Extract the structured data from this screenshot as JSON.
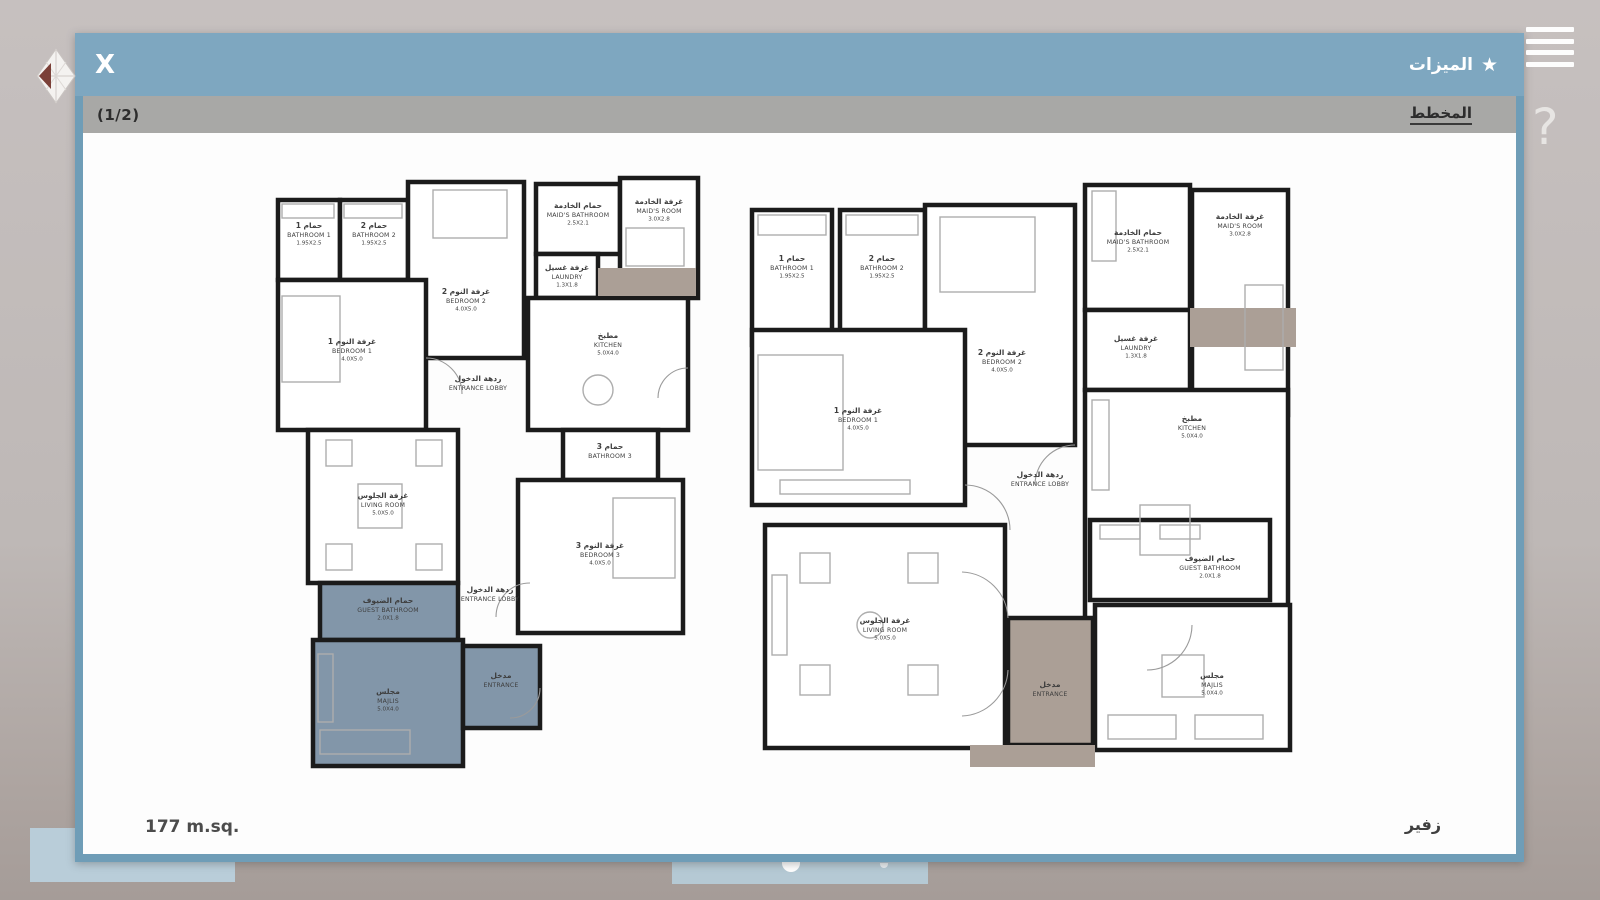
{
  "chrome": {
    "menu_icon": "hamburger-icon",
    "help_label": "?",
    "logo": "diamond-logo"
  },
  "dialog": {
    "close_label": "X",
    "features_label": "الميزات",
    "star_icon": "★",
    "pagination": "(1/2)",
    "plan_tab": "المخطط",
    "area_label": "177 m.sq.",
    "model_name": "زفير"
  },
  "colors": {
    "header_blue": "#7ea7c0",
    "dialog_border": "#6f9db7",
    "subheader_gray": "#a8a8a6",
    "wall": "#1b1b1b",
    "furniture": "#adadad",
    "porch": "#ab9f96",
    "blue_room": "#8296a9",
    "room_fill": "#ffffff",
    "label": "#3e3e3e"
  },
  "plans": [
    {
      "id": "left-floor-plan",
      "x": 185,
      "y": 35,
      "w": 436,
      "h": 604,
      "porches": [
        [
          330,
          100,
          98,
          28
        ]
      ],
      "rooms": [
        {
          "id": "bathroom-1",
          "r": [
            10,
            32,
            62,
            80
          ],
          "label": {
            "x": 41,
            "y": 60,
            "ar": "حمام 1",
            "en": "BATHROOM 1",
            "dim": "1.95X2.5"
          }
        },
        {
          "id": "bathroom-2",
          "r": [
            72,
            32,
            68,
            80
          ],
          "label": {
            "x": 106,
            "y": 60,
            "ar": "حمام 2",
            "en": "BATHROOM 2",
            "dim": "1.95X2.5"
          }
        },
        {
          "id": "bedroom-2",
          "r": [
            140,
            14,
            116,
            176
          ],
          "label": {
            "x": 198,
            "y": 126,
            "ar": "غرفة النوم 2",
            "en": "BEDROOM 2",
            "dim": "4.0X5.0"
          }
        },
        {
          "id": "maids-bathroom",
          "r": [
            268,
            16,
            84,
            70
          ],
          "label": {
            "x": 310,
            "y": 40,
            "ar": "حمام الخادمة",
            "en": "MAID'S BATHROOM",
            "dim": "2.5X2.1"
          }
        },
        {
          "id": "maids-room",
          "r": [
            352,
            10,
            78,
            120
          ],
          "label": {
            "x": 391,
            "y": 36,
            "ar": "غرفة الخادمة",
            "en": "MAID'S ROOM",
            "dim": "3.0X2.8"
          }
        },
        {
          "id": "laundry",
          "r": [
            268,
            86,
            62,
            44
          ],
          "label": {
            "x": 299,
            "y": 102,
            "ar": "غرفة غسيل",
            "en": "LAUNDRY",
            "dim": "1.3X1.8"
          }
        },
        {
          "id": "kitchen",
          "r": [
            260,
            130,
            160,
            132
          ],
          "label": {
            "x": 340,
            "y": 170,
            "ar": "مطبخ",
            "en": "KITCHEN",
            "dim": "5.0X4.0"
          }
        },
        {
          "id": "bedroom-1",
          "r": [
            10,
            112,
            148,
            150
          ],
          "label": {
            "x": 84,
            "y": 176,
            "ar": "غرفة النوم 1",
            "en": "BEDROOM 1",
            "dim": "4.0X5.0"
          }
        },
        {
          "id": "bathroom-3",
          "r": [
            295,
            262,
            95,
            50
          ],
          "label": {
            "x": 342,
            "y": 281,
            "ar": "حمام 3",
            "en": "BATHROOM 3",
            "dim": ""
          }
        },
        {
          "id": "living-room",
          "r": [
            40,
            262,
            150,
            153
          ],
          "label": {
            "x": 115,
            "y": 330,
            "ar": "غرفة الجلوس",
            "en": "LIVING ROOM",
            "dim": "5.0X5.0"
          }
        },
        {
          "id": "bedroom-3",
          "r": [
            250,
            312,
            165,
            153
          ],
          "label": {
            "x": 332,
            "y": 380,
            "ar": "غرفة النوم 3",
            "en": "BEDROOM 3",
            "dim": "4.0X5.0"
          }
        },
        {
          "id": "guest-bathroom",
          "r": [
            52,
            415,
            138,
            57
          ],
          "fill": "blue",
          "label": {
            "x": 120,
            "y": 435,
            "ar": "حمام الضيوف",
            "en": "GUEST BATHROOM",
            "dim": "2.0X1.8"
          }
        },
        {
          "id": "majlis",
          "r": [
            45,
            472,
            150,
            126
          ],
          "fill": "blue",
          "label": {
            "x": 120,
            "y": 526,
            "ar": "مجلس",
            "en": "MAJLIS",
            "dim": "5.0X4.0"
          }
        },
        {
          "id": "entrance",
          "r": [
            195,
            478,
            77,
            82
          ],
          "fill": "blue",
          "label": {
            "x": 233,
            "y": 510,
            "ar": "مدخل",
            "en": "ENTRANCE",
            "dim": ""
          }
        }
      ],
      "open_labels": [
        {
          "x": 210,
          "y": 213,
          "ar": "ردهة الدخول",
          "en": "ENTRANCE LOBBY"
        },
        {
          "x": 222,
          "y": 424,
          "ar": "ردهة الدخول",
          "en": "ENTRANCE LOBBY"
        }
      ],
      "furniture": [
        {
          "t": "r",
          "d": [
            14,
            36,
            52,
            14
          ]
        },
        {
          "t": "r",
          "d": [
            76,
            36,
            58,
            14
          ]
        },
        {
          "t": "r",
          "d": [
            165,
            22,
            74,
            48
          ]
        },
        {
          "t": "r",
          "d": [
            14,
            128,
            58,
            86
          ]
        },
        {
          "t": "r",
          "d": [
            358,
            60,
            58,
            38
          ]
        },
        {
          "t": "r",
          "d": [
            58,
            272,
            26,
            26
          ]
        },
        {
          "t": "r",
          "d": [
            148,
            272,
            26,
            26
          ]
        },
        {
          "t": "r",
          "d": [
            58,
            376,
            26,
            26
          ]
        },
        {
          "t": "r",
          "d": [
            148,
            376,
            26,
            26
          ]
        },
        {
          "t": "r",
          "d": [
            90,
            316,
            44,
            44
          ]
        },
        {
          "t": "r",
          "d": [
            345,
            330,
            62,
            80
          ]
        },
        {
          "t": "c",
          "d": [
            330,
            222,
            15
          ]
        },
        {
          "t": "r",
          "d": [
            52,
            562,
            90,
            24
          ]
        },
        {
          "t": "r",
          "d": [
            50,
            486,
            15,
            68
          ]
        }
      ],
      "arcs": [
        "M158,190 A36,36 0 0 1 194,226",
        "M262,415 A34,34 0 0 0 228,449",
        "M272,520 A30,30 0 0 1 242,550",
        "M420,200 A30,30 0 0 0 390,230"
      ]
    },
    {
      "id": "right-floor-plan",
      "x": 657,
      "y": 42,
      "w": 556,
      "h": 592,
      "porches": [
        [
          450,
          133,
          106,
          39
        ],
        [
          230,
          570,
          125,
          22
        ]
      ],
      "rooms": [
        {
          "id": "bathroom-1",
          "r": [
            12,
            35,
            80,
            135
          ],
          "label": {
            "x": 52,
            "y": 86,
            "ar": "حمام 1",
            "en": "BATHROOM 1",
            "dim": "1.95X2.5"
          }
        },
        {
          "id": "bathroom-2",
          "r": [
            100,
            35,
            85,
            135
          ],
          "label": {
            "x": 142,
            "y": 86,
            "ar": "حمام 2",
            "en": "BATHROOM 2",
            "dim": "1.95X2.5"
          }
        },
        {
          "id": "bedroom-2",
          "r": [
            185,
            30,
            150,
            240
          ],
          "label": {
            "x": 262,
            "y": 180,
            "ar": "غرفة النوم 2",
            "en": "BEDROOM 2",
            "dim": "4.0X5.0"
          }
        },
        {
          "id": "maids-bathroom",
          "r": [
            345,
            10,
            105,
            125
          ],
          "label": {
            "x": 398,
            "y": 60,
            "ar": "حمام الخادمة",
            "en": "MAID'S BATHROOM",
            "dim": "2.5X2.1"
          }
        },
        {
          "id": "maids-room",
          "r": [
            452,
            15,
            96,
            225
          ],
          "label": {
            "x": 500,
            "y": 44,
            "ar": "غرفة الخادمة",
            "en": "MAID'S ROOM",
            "dim": "3.0X2.8"
          }
        },
        {
          "id": "laundry",
          "r": [
            345,
            135,
            105,
            80
          ],
          "label": {
            "x": 396,
            "y": 166,
            "ar": "غرفة غسيل",
            "en": "LAUNDRY",
            "dim": "1.3X1.8"
          }
        },
        {
          "id": "kitchen",
          "r": [
            345,
            215,
            203,
            235
          ],
          "label": {
            "x": 452,
            "y": 246,
            "ar": "مطبخ",
            "en": "KITCHEN",
            "dim": "5.0X4.0"
          }
        },
        {
          "id": "bedroom-1",
          "r": [
            12,
            155,
            213,
            175
          ],
          "label": {
            "x": 118,
            "y": 238,
            "ar": "غرفة النوم 1",
            "en": "BEDROOM 1",
            "dim": "4.0X5.0"
          }
        },
        {
          "id": "living-room",
          "r": [
            25,
            350,
            240,
            223
          ],
          "label": {
            "x": 145,
            "y": 448,
            "ar": "غرفة الجلوس",
            "en": "LIVING ROOM",
            "dim": "5.0X5.0"
          }
        },
        {
          "id": "guest-bathroom",
          "r": [
            350,
            345,
            180,
            80
          ],
          "label": {
            "x": 470,
            "y": 386,
            "ar": "حمام الضيوف",
            "en": "GUEST BATHROOM",
            "dim": "2.0X1.8"
          }
        },
        {
          "id": "majlis",
          "r": [
            355,
            430,
            195,
            145
          ],
          "label": {
            "x": 472,
            "y": 503,
            "ar": "مجلس",
            "en": "MAJLIS",
            "dim": "5.0X4.0"
          }
        },
        {
          "id": "entrance",
          "r": [
            268,
            443,
            85,
            127
          ],
          "fill": "porch",
          "label": {
            "x": 310,
            "y": 512,
            "ar": "مدخل",
            "en": "ENTRANCE",
            "dim": ""
          }
        }
      ],
      "open_labels": [
        {
          "x": 300,
          "y": 302,
          "ar": "ردهة الدخول",
          "en": "ENTRANCE LOBBY"
        }
      ],
      "furniture": [
        {
          "t": "r",
          "d": [
            18,
            40,
            68,
            20
          ]
        },
        {
          "t": "r",
          "d": [
            106,
            40,
            72,
            20
          ]
        },
        {
          "t": "r",
          "d": [
            352,
            16,
            24,
            70
          ]
        },
        {
          "t": "r",
          "d": [
            200,
            42,
            95,
            75
          ]
        },
        {
          "t": "r",
          "d": [
            18,
            180,
            85,
            115
          ]
        },
        {
          "t": "r",
          "d": [
            505,
            110,
            38,
            85
          ]
        },
        {
          "t": "r",
          "d": [
            40,
            305,
            130,
            14
          ]
        },
        {
          "t": "r",
          "d": [
            60,
            378,
            30,
            30
          ]
        },
        {
          "t": "r",
          "d": [
            168,
            378,
            30,
            30
          ]
        },
        {
          "t": "r",
          "d": [
            60,
            490,
            30,
            30
          ]
        },
        {
          "t": "r",
          "d": [
            168,
            490,
            30,
            30
          ]
        },
        {
          "t": "c",
          "d": [
            130,
            450,
            13
          ]
        },
        {
          "t": "r",
          "d": [
            32,
            400,
            15,
            80
          ]
        },
        {
          "t": "r",
          "d": [
            368,
            540,
            68,
            24
          ]
        },
        {
          "t": "r",
          "d": [
            455,
            540,
            68,
            24
          ]
        },
        {
          "t": "r",
          "d": [
            422,
            480,
            42,
            42
          ]
        },
        {
          "t": "r",
          "d": [
            400,
            330,
            50,
            50
          ]
        },
        {
          "t": "r",
          "d": [
            352,
            225,
            17,
            90
          ]
        },
        {
          "t": "r",
          "d": [
            360,
            350,
            40,
            14
          ]
        },
        {
          "t": "r",
          "d": [
            420,
            350,
            40,
            14
          ]
        }
      ],
      "arcs": [
        "M225,310 A45,45 0 0 1 270,355",
        "M335,270 A40,40 0 0 0 295,310",
        "M452,450 A45,45 0 0 1 407,495",
        "M268,443 A48,48 0 0 0 222,397",
        "M268,495 A48,48 0 0 1 222,541"
      ]
    }
  ]
}
